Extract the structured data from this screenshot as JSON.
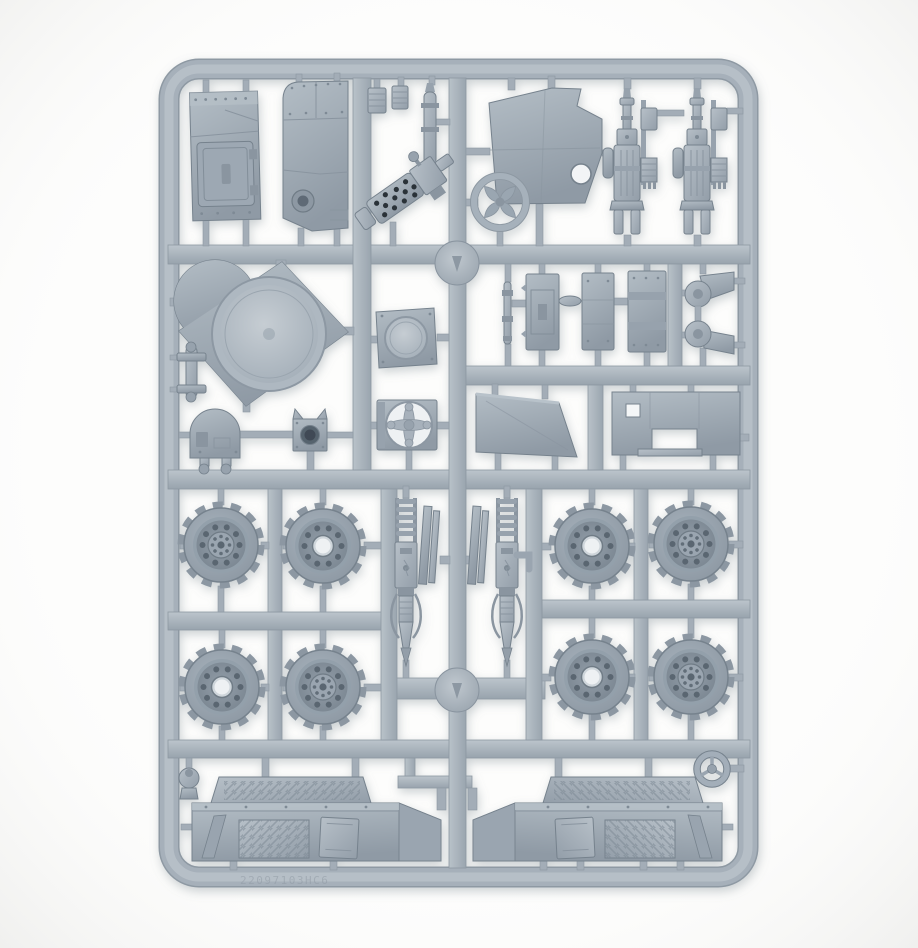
{
  "palette": {
    "background": "#fdfdfc",
    "background_edge": "#efefed",
    "plastic_light": "#c2cad1",
    "plastic_mid": "#a6b0ba",
    "plastic_dark": "#8d98a2",
    "recess": "#5f6b76",
    "hole_black": "#2a3038",
    "shadow": "#7c8791",
    "emboss_color": "#8f99a3"
  },
  "sprue": {
    "embossed_code": "22097103HC6",
    "parts": [
      {
        "id": "sprue-frame",
        "label": "sprue frame and runners"
      },
      {
        "id": "injection-gate-disc-top",
        "label": "round injection gate"
      },
      {
        "id": "injection-gate-disc-bottom",
        "label": "round injection gate"
      },
      {
        "id": "armor-door-panel",
        "label": "riveted armour panel with hatch"
      },
      {
        "id": "curved-armor-panel",
        "label": "riveted armour panel with round port"
      },
      {
        "id": "spring-clip-a",
        "label": "small ribbed clip"
      },
      {
        "id": "spring-clip-b",
        "label": "small ribbed clip"
      },
      {
        "id": "bent-exhaust-pipe",
        "label": "bent exhaust pipe"
      },
      {
        "id": "perforated-gun",
        "label": "gun with perforated barrel shroud"
      },
      {
        "id": "cab-panel",
        "label": "cab panel with circular opening"
      },
      {
        "id": "four-spoke-ring",
        "label": "ring with four spoke blades"
      },
      {
        "id": "exhaust-stack-a",
        "label": "ribbed exhaust stack with bracket"
      },
      {
        "id": "exhaust-stack-b",
        "label": "ribbed exhaust stack with bracket"
      },
      {
        "id": "turret-ring-plate",
        "label": "deck plate with large turret ring"
      },
      {
        "id": "hinge-post",
        "label": "flanged hinge post"
      },
      {
        "id": "domed-housing",
        "label": "domed housing with feet"
      },
      {
        "id": "socket-block",
        "label": "block with round socket and ears"
      },
      {
        "id": "round-hatch-plate",
        "label": "square plate with round hatch"
      },
      {
        "id": "cross-hub-plate",
        "label": "plate with cross-shaped hub opening"
      },
      {
        "id": "linkage-rod",
        "label": "thin linkage rod"
      },
      {
        "id": "detail-plate-a",
        "label": "small detail plate"
      },
      {
        "id": "detail-plate-b",
        "label": "small detail plate"
      },
      {
        "id": "detail-plate-c",
        "label": "riveted banded plate"
      },
      {
        "id": "axle-bracket-a",
        "label": "axle mount bracket with boss"
      },
      {
        "id": "axle-bracket-b",
        "label": "axle mount bracket with boss"
      },
      {
        "id": "floor-plate",
        "label": "sloped floor plate"
      },
      {
        "id": "bench-panel",
        "label": "notched bench panel with square hole"
      },
      {
        "id": "road-wheel-1",
        "label": "chunky road wheel, hub cap face"
      },
      {
        "id": "road-wheel-2",
        "label": "chunky road wheel, open hub face"
      },
      {
        "id": "road-wheel-3",
        "label": "chunky road wheel, open hub face"
      },
      {
        "id": "road-wheel-4",
        "label": "chunky road wheel, hub cap face"
      },
      {
        "id": "road-wheel-5",
        "label": "chunky road wheel, open hub face"
      },
      {
        "id": "road-wheel-6",
        "label": "chunky road wheel, hub cap face"
      },
      {
        "id": "road-wheel-7",
        "label": "chunky road wheel, open hub face"
      },
      {
        "id": "road-wheel-8",
        "label": "chunky road wheel, hub cap face"
      },
      {
        "id": "suspension-strut-a",
        "label": "coil-spring suspension strut"
      },
      {
        "id": "suspension-strut-b",
        "label": "coil-spring suspension strut"
      },
      {
        "id": "leaf-strips-a",
        "label": "leaf spring strips"
      },
      {
        "id": "leaf-strips-b",
        "label": "leaf spring strips"
      },
      {
        "id": "side-skirt-left",
        "label": "tread-plate side skirt panel"
      },
      {
        "id": "side-skirt-right",
        "label": "tread-plate side skirt panel, mirrored"
      },
      {
        "id": "horn-knob",
        "label": "small horn knob"
      },
      {
        "id": "steering-wheel",
        "label": "three-spoke steering wheel"
      }
    ]
  }
}
